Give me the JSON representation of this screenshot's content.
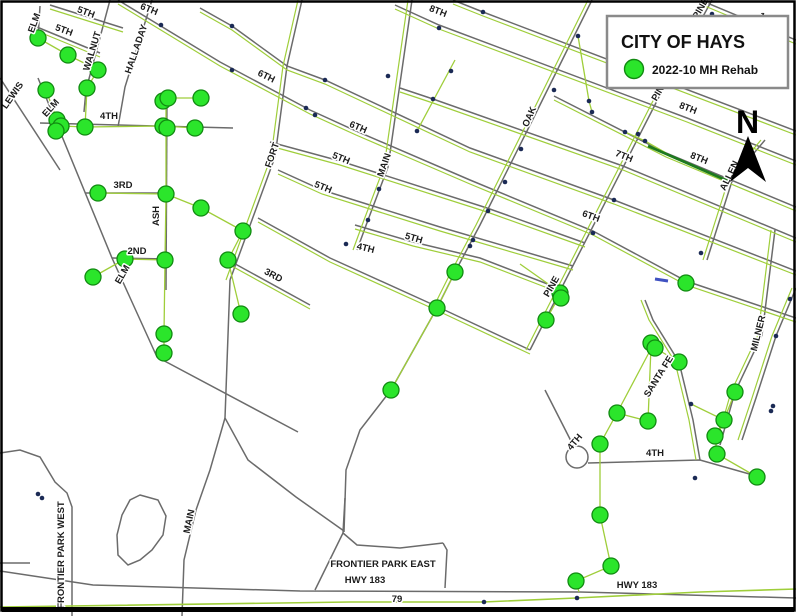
{
  "legend": {
    "title": "CITY OF HAYS",
    "item_label": "2022-10 MH Rehab"
  },
  "north": {
    "letter": "N"
  },
  "colors": {
    "street": "#6b6b6b",
    "sewer": "#9fce3a",
    "route": "#9fce3a",
    "manhole_fill": "#2be52b",
    "manhole_edge": "#118a11",
    "node": "#1b2a55",
    "dark_green": "#1d7a1d",
    "blue_dash": "#3f51c1",
    "frame": "#000000",
    "legend_border": "#8a8a8a"
  },
  "map": {
    "streets": [
      {
        "n": "lewis",
        "p": [
          0,
          78,
          60,
          170
        ]
      },
      {
        "n": "elm-diagonal",
        "p": [
          38,
          78,
          112,
          258,
          157,
          357,
          298,
          432
        ]
      },
      {
        "n": "walnut",
        "p": [
          110,
          0,
          86,
          90,
          84,
          112
        ]
      },
      {
        "n": "halladay",
        "p": [
          152,
          0,
          125,
          87,
          118,
          127
        ]
      },
      {
        "n": "4th-west",
        "p": [
          40,
          123,
          233,
          128
        ]
      },
      {
        "n": "3rd-west",
        "p": [
          85,
          193,
          168,
          193
        ]
      },
      {
        "n": "2nd-west",
        "p": [
          112,
          258,
          168,
          259
        ]
      },
      {
        "n": "ash",
        "p": [
          167,
          95,
          166,
          290
        ]
      },
      {
        "n": "elm-stub",
        "p": [
          40,
          6,
          38,
          38
        ]
      },
      {
        "n": "5th-stub-a",
        "p": [
          32,
          25,
          100,
          53
        ],
        "o": [
          0,
          4
        ]
      },
      {
        "n": "5th-stub-b",
        "p": [
          50,
          5,
          123,
          28
        ],
        "o": [
          0,
          4
        ]
      },
      {
        "n": "11th-ave",
        "p": [
          700,
          0,
          796,
          40
        ],
        "o": [
          0,
          4
        ]
      },
      {
        "n": "9th-ave",
        "p": [
          453,
          0,
          483,
          12,
          796,
          131
        ],
        "o": [
          0,
          4
        ]
      },
      {
        "n": "8th-ave",
        "p": [
          395,
          5,
          439,
          25,
          687,
          118,
          796,
          161
        ],
        "o": [
          0,
          4
        ]
      },
      {
        "n": "8th-ave-b",
        "p": [
          554,
          96,
          666,
          153,
          796,
          207
        ],
        "o": [
          0,
          4
        ]
      },
      {
        "n": "7th-ave",
        "p": [
          400,
          88,
          433,
          99,
          623,
          166,
          796,
          238
        ],
        "o": [
          0,
          4
        ]
      },
      {
        "n": "mid-ave",
        "p": [
          200,
          8,
          232,
          26,
          287,
          66,
          325,
          80,
          470,
          148,
          614,
          200,
          796,
          271
        ],
        "o": [
          0,
          4
        ]
      },
      {
        "n": "6th-ave",
        "p": [
          118,
          0,
          220,
          62,
          310,
          110,
          356,
          131,
          470,
          180,
          593,
          231,
          686,
          281,
          796,
          318
        ],
        "o": [
          0,
          4
        ]
      },
      {
        "n": "5th-ave-a",
        "p": [
          270,
          142,
          340,
          161,
          487,
          208,
          585,
          243
        ],
        "o": [
          0,
          4
        ]
      },
      {
        "n": "5th-ave-b",
        "p": [
          278,
          170,
          322,
          190,
          440,
          227,
          573,
          266
        ],
        "o": [
          0,
          4
        ]
      },
      {
        "n": "5th-ave-c",
        "p": [
          355,
          225,
          413,
          242,
          480,
          258,
          558,
          288
        ],
        "o": [
          0,
          4
        ]
      },
      {
        "n": "4th-ave",
        "p": [
          258,
          218,
          330,
          258,
          436,
          306,
          530,
          350
        ],
        "o": [
          0,
          4
        ]
      },
      {
        "n": "3rd-ave",
        "p": [
          228,
          260,
          310,
          305
        ],
        "o": [
          0,
          4
        ]
      },
      {
        "n": "fort",
        "p": [
          302,
          0,
          287,
          66,
          275,
          157,
          230,
          280
        ],
        "o": [
          -4,
          0
        ]
      },
      {
        "n": "main-grid",
        "p": [
          412,
          0,
          388,
          167,
          368,
          220,
          357,
          250
        ],
        "o": [
          -4,
          0
        ]
      },
      {
        "n": "oak",
        "p": [
          592,
          0,
          533,
          119,
          480,
          225,
          455,
          272,
          437,
          308
        ],
        "o": [
          -4,
          0
        ]
      },
      {
        "n": "oak-south-road",
        "p": [
          437,
          308,
          391,
          390,
          360,
          430,
          346,
          470,
          344,
          532
        ]
      },
      {
        "n": "pine",
        "p": [
          712,
          0,
          661,
          93,
          560,
          291,
          530,
          350
        ],
        "o": [
          -4,
          0
        ]
      },
      {
        "n": "allen",
        "p": [
          765,
          140,
          733,
          178,
          707,
          260
        ],
        "o": [
          -4,
          0
        ]
      },
      {
        "n": "milner",
        "p": [
          775,
          230,
          762,
          335,
          735,
          392,
          720,
          445
        ],
        "o": [
          -4,
          0
        ]
      },
      {
        "n": "east-edge-street",
        "p": [
          796,
          288,
          776,
          336,
          756,
          398,
          742,
          440
        ],
        "o": [
          -4,
          0
        ]
      },
      {
        "n": "santa-fe",
        "p": [
          645,
          300,
          653,
          320,
          679,
          362,
          693,
          420,
          700,
          460
        ],
        "o": [
          -4,
          0
        ]
      },
      {
        "n": "4th-south",
        "p": [
          588,
          463,
          700,
          460,
          760,
          477
        ]
      },
      {
        "n": "4th-approach",
        "p": [
          545,
          390,
          572,
          443
        ]
      },
      {
        "n": "fort-south",
        "p": [
          230,
          280,
          225,
          418,
          248,
          460,
          296,
          497,
          344,
          531
        ]
      },
      {
        "n": "main-south",
        "p": [
          225,
          418,
          210,
          470,
          196,
          510,
          184,
          560,
          182,
          616
        ]
      },
      {
        "n": "hwy-183",
        "p": [
          0,
          571,
          93,
          585,
          300,
          591,
          580,
          592,
          796,
          598
        ]
      },
      {
        "n": "frontier-park-west-road",
        "p": [
          0,
          453,
          20,
          450,
          40,
          457,
          55,
          482,
          67,
          493,
          72,
          507,
          72,
          616
        ]
      },
      {
        "n": "west-stub",
        "p": [
          0,
          563,
          30,
          563
        ]
      },
      {
        "n": "park-east-top",
        "p": [
          343,
          533,
          357,
          545,
          400,
          548,
          443,
          543
        ]
      },
      {
        "n": "park-east-right",
        "p": [
          443,
          543,
          447,
          550,
          445,
          588
        ]
      },
      {
        "n": "park-east-left",
        "p": [
          315,
          590,
          343,
          533
        ]
      },
      {
        "n": "park-east-stub",
        "p": [
          345,
          498,
          343,
          533
        ]
      }
    ],
    "circles": [
      {
        "x": 577,
        "y": 457,
        "r": 11
      }
    ],
    "pond": [
      140,
      495,
      158,
      500,
      166,
      516,
      163,
      535,
      152,
      550,
      140,
      560,
      128,
      565,
      118,
      555,
      117,
      535,
      122,
      515,
      130,
      500
    ],
    "sewers": [
      [
        38,
        38,
        68,
        55,
        98,
        70
      ],
      [
        98,
        70,
        87,
        88,
        85,
        127
      ],
      [
        46,
        90,
        57,
        120
      ],
      [
        57,
        120,
        61,
        126,
        85,
        127,
        163,
        126,
        195,
        128
      ],
      [
        166,
        98,
        166,
        126,
        166,
        194,
        165,
        260,
        164,
        334,
        164,
        353
      ],
      [
        163,
        101,
        168,
        98,
        201,
        98
      ],
      [
        98,
        193,
        166,
        194
      ],
      [
        125,
        259,
        165,
        260
      ],
      [
        93,
        277,
        125,
        259
      ],
      [
        166,
        194,
        201,
        208,
        243,
        231
      ],
      [
        243,
        231,
        228,
        260,
        241,
        314
      ],
      [
        455,
        272,
        437,
        308,
        391,
        390
      ],
      [
        520,
        264,
        561,
        293,
        546,
        320
      ],
      [
        653,
        345,
        617,
        413,
        600,
        444,
        600,
        515,
        611,
        566,
        576,
        581,
        579,
        592
      ],
      [
        651,
        343,
        655,
        348,
        679,
        362
      ],
      [
        651,
        347,
        648,
        421,
        617,
        413
      ],
      [
        691,
        404,
        724,
        420,
        715,
        436,
        717,
        454,
        757,
        477
      ],
      [
        735,
        392,
        724,
        420
      ],
      [
        589,
        101,
        592,
        112
      ],
      [
        625,
        132,
        645,
        141,
        666,
        153
      ],
      [
        455,
        60,
        417,
        131
      ],
      [
        578,
        36,
        589,
        101
      ]
    ],
    "route_79": [
      0,
      607,
      350,
      602,
      483,
      602,
      576,
      598,
      700,
      592,
      796,
      589
    ],
    "dark_segment": [
      648,
      146,
      728,
      181
    ],
    "blue_dash": [
      655,
      279,
      668,
      281
    ],
    "nodes": [
      161,
      25,
      232,
      26,
      439,
      28,
      483,
      12,
      578,
      36,
      712,
      14,
      589,
      101,
      592,
      112,
      625,
      132,
      638,
      134,
      645,
      141,
      614,
      200,
      593,
      233,
      379,
      189,
      368,
      220,
      346,
      244,
      417,
      131,
      306,
      108,
      315,
      115,
      388,
      76,
      325,
      80,
      232,
      70,
      521,
      149,
      505,
      182,
      488,
      211,
      473,
      240,
      470,
      246,
      554,
      90,
      451,
      71,
      433,
      99,
      691,
      404,
      695,
      478,
      773,
      406,
      771,
      411,
      790,
      299,
      776,
      336,
      701,
      253,
      484,
      602,
      577,
      598,
      38,
      494,
      42,
      498
    ],
    "manholes": [
      38,
      38,
      68,
      55,
      98,
      70,
      87,
      88,
      46,
      90,
      57,
      120,
      61,
      126,
      56,
      131,
      85,
      127,
      163,
      101,
      168,
      98,
      201,
      98,
      163,
      126,
      167,
      128,
      195,
      128,
      98,
      193,
      166,
      194,
      201,
      208,
      243,
      231,
      125,
      259,
      165,
      260,
      93,
      277,
      228,
      260,
      241,
      314,
      164,
      334,
      164,
      353,
      455,
      272,
      437,
      308,
      391,
      390,
      560,
      293,
      561,
      298,
      546,
      320,
      686,
      283,
      651,
      343,
      655,
      348,
      679,
      362,
      735,
      392,
      617,
      413,
      648,
      421,
      600,
      444,
      724,
      420,
      715,
      436,
      717,
      454,
      757,
      477,
      600,
      515,
      611,
      566,
      576,
      581
    ],
    "labels": [
      [
        "5TH",
        63,
        33,
        20
      ],
      [
        "5TH",
        85,
        15,
        20
      ],
      [
        "6TH",
        148,
        12,
        22
      ],
      [
        "6TH",
        265,
        79,
        26
      ],
      [
        "6TH",
        357,
        130,
        23
      ],
      [
        "5TH",
        340,
        161,
        22
      ],
      [
        "5TH",
        322,
        190,
        22
      ],
      [
        "5TH",
        413,
        241,
        16
      ],
      [
        "4TH",
        365,
        251,
        14
      ],
      [
        "3RD",
        272,
        278,
        28
      ],
      [
        "8TH",
        437,
        14,
        21
      ],
      [
        "8TH",
        687,
        111,
        21
      ],
      [
        "8TH",
        698,
        161,
        22
      ],
      [
        "7TH",
        623,
        159,
        22
      ],
      [
        "6TH",
        590,
        219,
        20
      ],
      [
        "11TH",
        768,
        23,
        30
      ],
      [
        "4TH",
        109,
        119,
        0
      ],
      [
        "3RD",
        123,
        188,
        0
      ],
      [
        "2ND",
        137,
        254,
        0
      ],
      [
        "4TH",
        655,
        456,
        0
      ],
      [
        "HWY 183",
        365,
        583,
        0
      ],
      [
        "HWY 183",
        637,
        588,
        0
      ],
      [
        "79",
        397,
        602,
        0
      ],
      [
        "FRONTIER PARK EAST",
        383,
        567,
        0
      ],
      [
        "LEWIS",
        15,
        97,
        -55
      ],
      [
        "ELM",
        37,
        24,
        -70
      ],
      [
        "ELM",
        53,
        110,
        -48
      ],
      [
        "ELM",
        125,
        276,
        -60
      ],
      [
        "WALNUT",
        95,
        52,
        -73
      ],
      [
        "HALLADAY",
        139,
        50,
        -71
      ],
      [
        "ASH",
        159,
        216,
        -90
      ],
      [
        "FORT",
        275,
        156,
        -71
      ],
      [
        "MAIN",
        387,
        166,
        -71
      ],
      [
        "OAK",
        532,
        118,
        -66
      ],
      [
        "PINE",
        554,
        288,
        -60
      ],
      [
        "PINE",
        662,
        92,
        -60
      ],
      [
        "PINE",
        703,
        10,
        -60
      ],
      [
        "ALLEN",
        732,
        177,
        -64
      ],
      [
        "MILNER",
        761,
        334,
        -76
      ],
      [
        "SANTA FE",
        661,
        378,
        -58
      ],
      [
        "MAIN",
        192,
        522,
        -78
      ],
      [
        "FRONTIER PARK WEST",
        64,
        555,
        -90
      ],
      [
        "4TH",
        577,
        444,
        -50
      ]
    ]
  }
}
